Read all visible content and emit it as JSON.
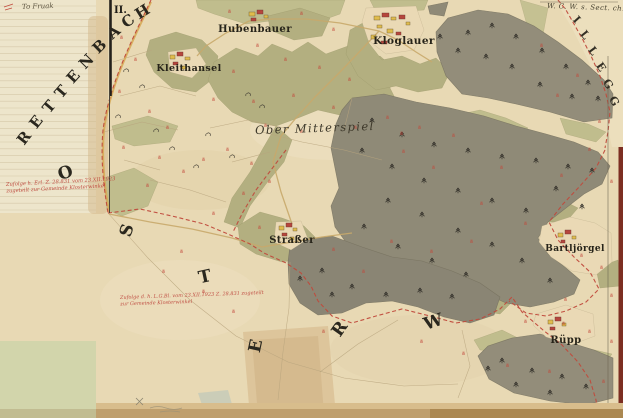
{
  "map": {
    "sheet_number": "II.",
    "corner_note": "W. C. W. s. Sect. ch.",
    "margin_note": "To Fruak",
    "district_label": "Ober Mitterspiel",
    "boundary_name": {
      "text": "RETTENBACH",
      "letters": [
        {
          "ch": "R",
          "x": 28,
          "y": 141,
          "r": -52
        },
        {
          "ch": "E",
          "x": 40,
          "y": 125,
          "r": -52
        },
        {
          "ch": "T",
          "x": 53,
          "y": 110,
          "r": -50
        },
        {
          "ch": "T",
          "x": 65,
          "y": 95,
          "r": -49
        },
        {
          "ch": "E",
          "x": 77,
          "y": 80,
          "r": -48
        },
        {
          "ch": "N",
          "x": 90,
          "y": 65,
          "r": -46
        },
        {
          "ch": "B",
          "x": 103,
          "y": 50,
          "r": -44
        },
        {
          "ch": "A",
          "x": 117,
          "y": 36,
          "r": -40
        },
        {
          "ch": "C",
          "x": 131,
          "y": 25,
          "r": -36
        },
        {
          "ch": "H",
          "x": 145,
          "y": 16,
          "r": -32
        }
      ]
    },
    "area_name": {
      "text": "OSTERW",
      "letters": [
        {
          "ch": "O",
          "x": 67,
          "y": 178,
          "r": -18
        },
        {
          "ch": "S",
          "x": 132,
          "y": 232,
          "r": -72
        },
        {
          "ch": "T",
          "x": 206,
          "y": 282,
          "r": -12
        },
        {
          "ch": "E",
          "x": 261,
          "y": 347,
          "r": -78
        },
        {
          "ch": "R",
          "x": 344,
          "y": 332,
          "r": -55
        },
        {
          "ch": "W",
          "x": 435,
          "y": 327,
          "r": -18
        }
      ]
    },
    "neighbor_name": {
      "text": "ILLEGG",
      "letters": [
        {
          "ch": "I",
          "x": 574,
          "y": 22,
          "r": 48
        },
        {
          "ch": "L",
          "x": 582,
          "y": 37,
          "r": 52
        },
        {
          "ch": "L",
          "x": 590,
          "y": 53,
          "r": 54
        },
        {
          "ch": "E",
          "x": 598,
          "y": 69,
          "r": 56
        },
        {
          "ch": "G",
          "x": 605,
          "y": 86,
          "r": 58
        },
        {
          "ch": "G",
          "x": 611,
          "y": 103,
          "r": 60
        }
      ]
    },
    "settlements": [
      {
        "name": "Hubenbauer",
        "x": 255,
        "y": 32,
        "size": 10
      },
      {
        "name": "Kloglauer",
        "x": 404,
        "y": 44,
        "size": 10.5
      },
      {
        "name": "Kleithansel",
        "x": 189,
        "y": 71,
        "size": 9.5
      },
      {
        "name": "Straßer",
        "x": 292,
        "y": 243,
        "size": 10
      },
      {
        "name": "Bartljörgel",
        "x": 575,
        "y": 251,
        "size": 9
      },
      {
        "name": "Rüpp",
        "x": 566,
        "y": 343,
        "size": 10
      }
    ],
    "red_notes": [
      {
        "x": 6,
        "y": 186,
        "rotate": -3,
        "size": 5.2,
        "lines": [
          "Zufolge h. Erl. Z. 28.831 vom 23.XII.1923",
          "zugeteilt zur Gemeinde Klosterwinkel"
        ]
      },
      {
        "x": 120,
        "y": 299,
        "rotate": -2,
        "size": 5.0,
        "lines": [
          "Zufolge d. h. L.G.Bl. vom 23.XII.1923 Z. 28.831 zugeteilt",
          "zur Gemeinde Klosterwinkel"
        ]
      }
    ],
    "colors": {
      "parchment": "#e8d9b4",
      "margin_paper": "#ede5cb",
      "woodland_green": "#b3af80",
      "forest_grey": "#8f8a77",
      "pale_green_block": "#d2d5ab",
      "boundary_red": "#c04a3c",
      "parcel_red": "#c2463a",
      "building_yellow": "#e0bc4c",
      "building_red": "#b5463c",
      "edge_maroon": "#7c2e22"
    }
  }
}
